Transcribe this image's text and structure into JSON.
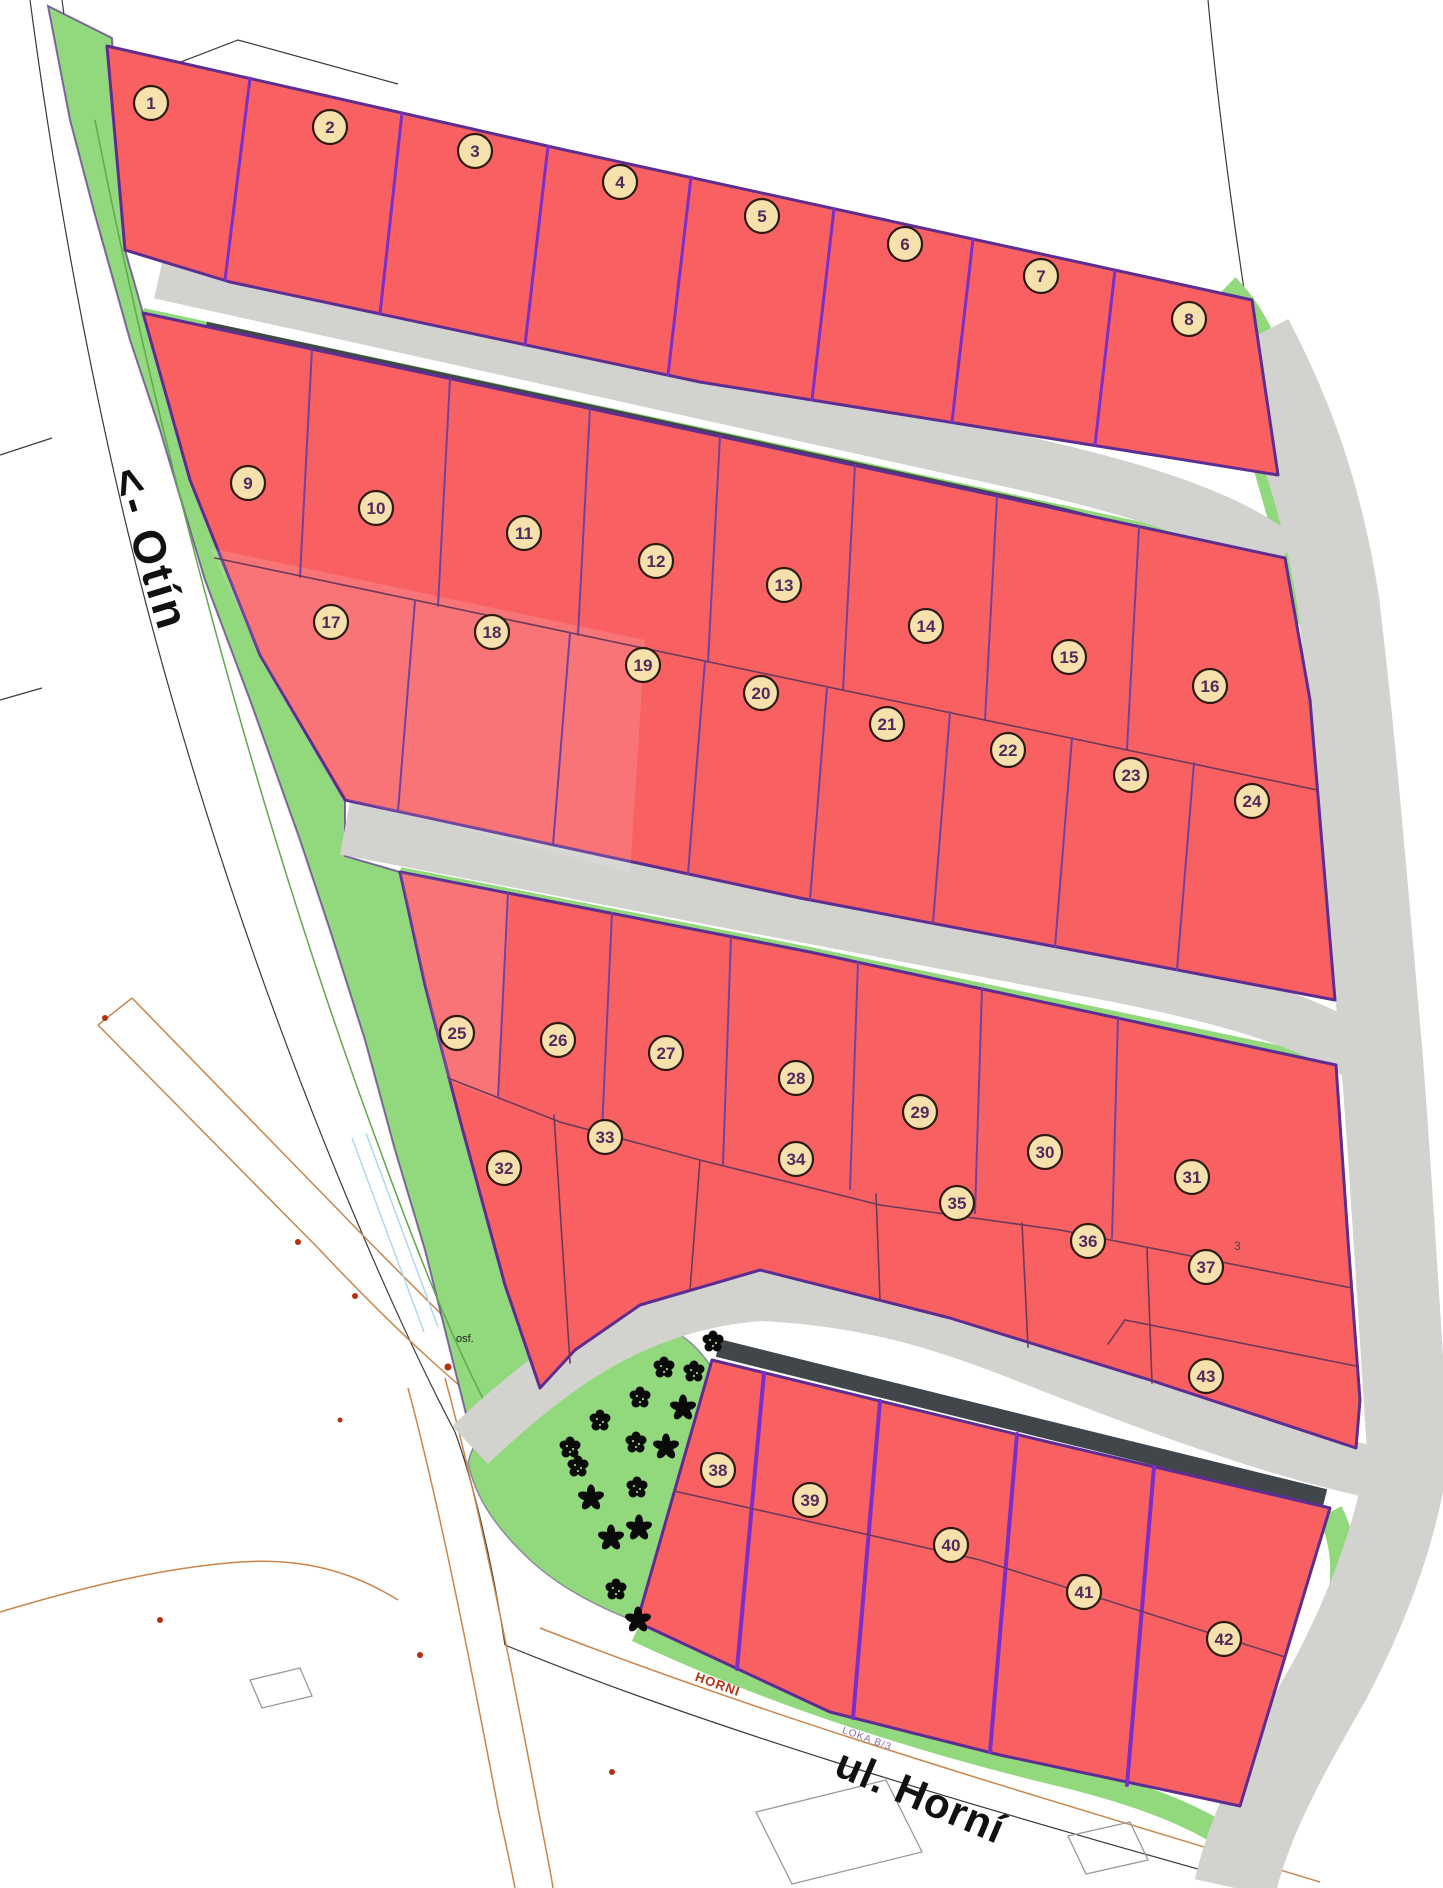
{
  "map": {
    "labels": {
      "street_left": "<- Otín",
      "street_bottom": "ul. Horní",
      "street_bottom_small": "HORNI",
      "locality_note": "LOKA B/3",
      "surface_note": "osf.",
      "stray_digit": "3"
    },
    "colors": {
      "plot_red": "#f96062",
      "green": "#92d87d",
      "green_dark": "#5fa84e",
      "road_gray": "#d2d3cf",
      "dark_strip": "#41464a",
      "border_purple": "#5e2d91",
      "divider_purple": "#7b2fc8",
      "divider_mid": "#7440a0",
      "divider_thin": "#6b3a5a",
      "badge_fill": "#f6e0ac",
      "badge_ring": "#2b1b12",
      "badge_text": "#54285a",
      "bg_line": "#3a3a3a",
      "cadastral_orange": "#c9854b",
      "building_gray": "#999999",
      "symbol_red": "#b5300f",
      "water_cyan": "#a9d6e8",
      "label_black": "#111111",
      "tree_black": "#0a0a0a"
    },
    "plots": [
      {
        "n": "1",
        "x": 151,
        "y": 103
      },
      {
        "n": "2",
        "x": 330,
        "y": 127
      },
      {
        "n": "3",
        "x": 475,
        "y": 151
      },
      {
        "n": "4",
        "x": 620,
        "y": 182
      },
      {
        "n": "5",
        "x": 762,
        "y": 216
      },
      {
        "n": "6",
        "x": 905,
        "y": 244
      },
      {
        "n": "7",
        "x": 1041,
        "y": 276
      },
      {
        "n": "8",
        "x": 1189,
        "y": 319
      },
      {
        "n": "9",
        "x": 248,
        "y": 483
      },
      {
        "n": "10",
        "x": 376,
        "y": 508
      },
      {
        "n": "11",
        "x": 524,
        "y": 533
      },
      {
        "n": "12",
        "x": 656,
        "y": 561
      },
      {
        "n": "13",
        "x": 784,
        "y": 585
      },
      {
        "n": "14",
        "x": 926,
        "y": 626
      },
      {
        "n": "15",
        "x": 1069,
        "y": 657
      },
      {
        "n": "16",
        "x": 1210,
        "y": 686
      },
      {
        "n": "17",
        "x": 331,
        "y": 622
      },
      {
        "n": "18",
        "x": 492,
        "y": 632
      },
      {
        "n": "19",
        "x": 643,
        "y": 665
      },
      {
        "n": "20",
        "x": 761,
        "y": 693
      },
      {
        "n": "21",
        "x": 887,
        "y": 724
      },
      {
        "n": "22",
        "x": 1008,
        "y": 750
      },
      {
        "n": "23",
        "x": 1131,
        "y": 775
      },
      {
        "n": "24",
        "x": 1252,
        "y": 801
      },
      {
        "n": "25",
        "x": 457,
        "y": 1033
      },
      {
        "n": "26",
        "x": 558,
        "y": 1040
      },
      {
        "n": "27",
        "x": 666,
        "y": 1053
      },
      {
        "n": "28",
        "x": 796,
        "y": 1078
      },
      {
        "n": "29",
        "x": 920,
        "y": 1112
      },
      {
        "n": "30",
        "x": 1045,
        "y": 1152
      },
      {
        "n": "31",
        "x": 1192,
        "y": 1177
      },
      {
        "n": "32",
        "x": 504,
        "y": 1168
      },
      {
        "n": "33",
        "x": 605,
        "y": 1137
      },
      {
        "n": "34",
        "x": 796,
        "y": 1159
      },
      {
        "n": "35",
        "x": 957,
        "y": 1203
      },
      {
        "n": "36",
        "x": 1088,
        "y": 1241
      },
      {
        "n": "37",
        "x": 1206,
        "y": 1267
      },
      {
        "n": "38",
        "x": 718,
        "y": 1470
      },
      {
        "n": "39",
        "x": 810,
        "y": 1500
      },
      {
        "n": "40",
        "x": 951,
        "y": 1545
      },
      {
        "n": "41",
        "x": 1084,
        "y": 1592
      },
      {
        "n": "42",
        "x": 1224,
        "y": 1639
      },
      {
        "n": "43",
        "x": 1206,
        "y": 1376
      }
    ],
    "trees": [
      {
        "t": "round",
        "x": 713,
        "y": 1342
      },
      {
        "t": "round",
        "x": 664,
        "y": 1368
      },
      {
        "t": "round",
        "x": 694,
        "y": 1372
      },
      {
        "t": "round",
        "x": 640,
        "y": 1398
      },
      {
        "t": "star",
        "x": 683,
        "y": 1408
      },
      {
        "t": "round",
        "x": 600,
        "y": 1421
      },
      {
        "t": "round",
        "x": 570,
        "y": 1448
      },
      {
        "t": "star",
        "x": 666,
        "y": 1447
      },
      {
        "t": "round",
        "x": 636,
        "y": 1443
      },
      {
        "t": "round",
        "x": 578,
        "y": 1467
      },
      {
        "t": "star",
        "x": 591,
        "y": 1498
      },
      {
        "t": "round",
        "x": 637,
        "y": 1488
      },
      {
        "t": "star",
        "x": 611,
        "y": 1538
      },
      {
        "t": "star",
        "x": 639,
        "y": 1528
      },
      {
        "t": "round",
        "x": 616,
        "y": 1590
      },
      {
        "t": "star",
        "x": 638,
        "y": 1620
      }
    ]
  }
}
